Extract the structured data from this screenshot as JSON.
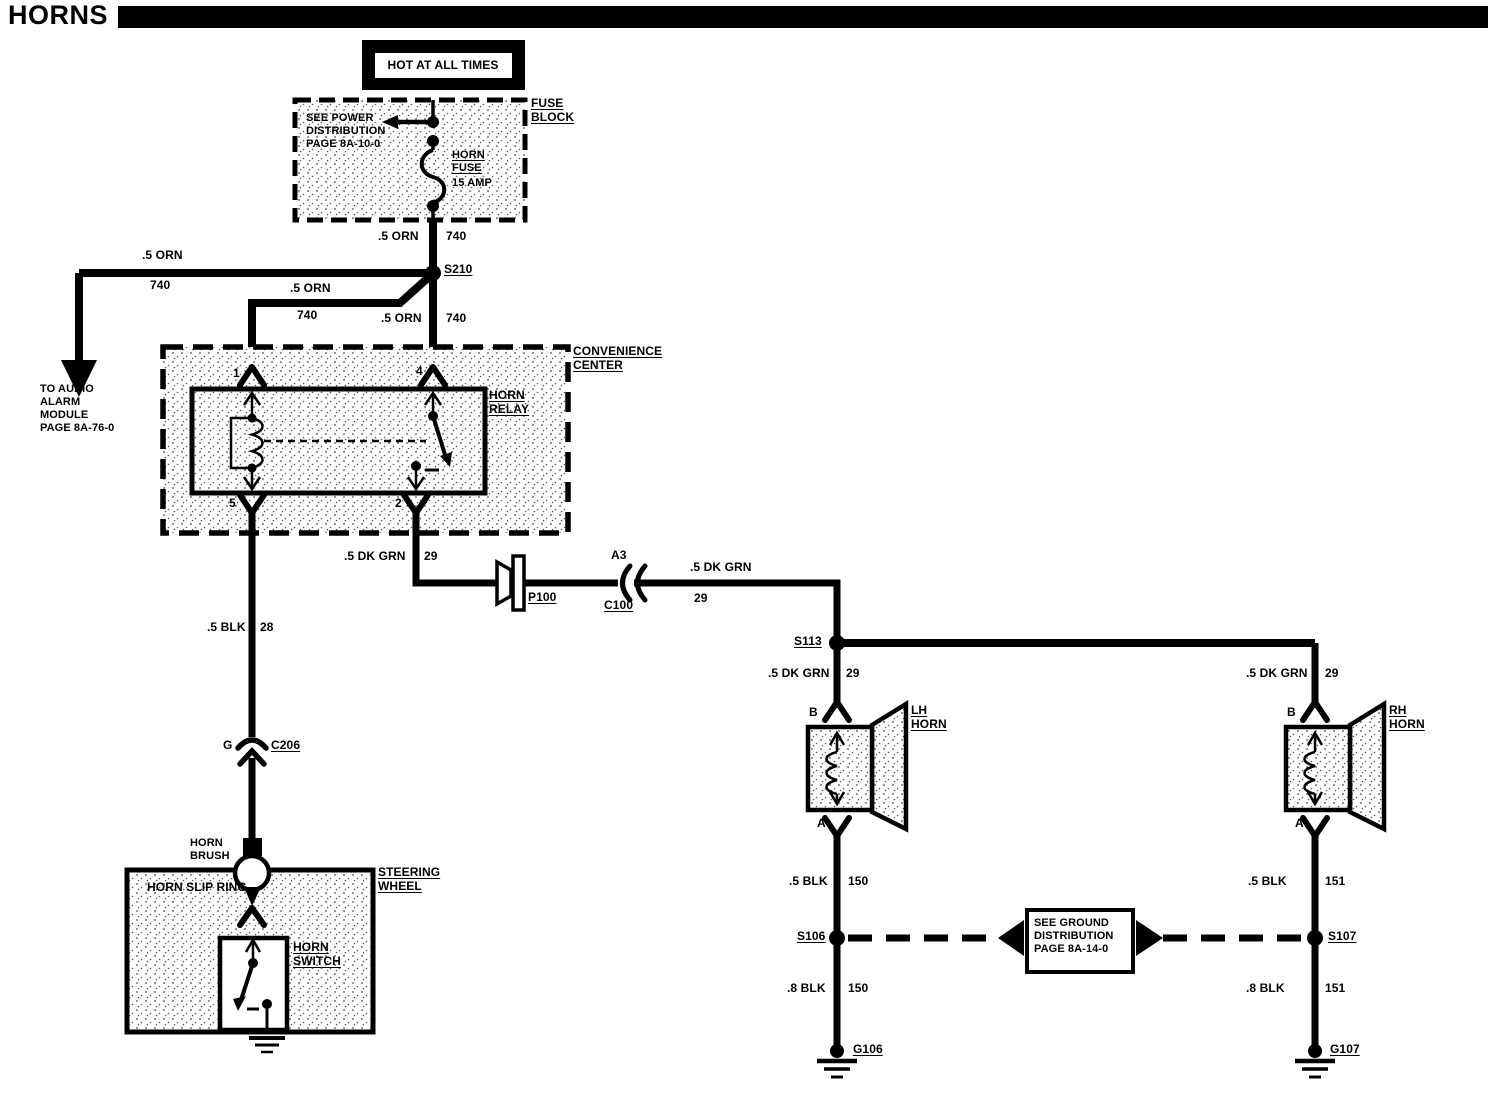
{
  "title": "HORNS",
  "colors": {
    "ink": "#000000",
    "paper": "#ffffff"
  },
  "power_source": {
    "label": "HOT AT ALL TIMES"
  },
  "fuse_block": {
    "name": "FUSE\nBLOCK",
    "power_note": "SEE POWER\nDISTRIBUTION\nPAGE 8A-10-0",
    "fuse_name": "HORN\nFUSE",
    "fuse_rating": "15 AMP"
  },
  "audio_note": "TO AUDIO\nALARM\nMODULE\nPAGE 8A-76-0",
  "ground_note": "SEE GROUND\nDISTRIBUTION\nPAGE 8A-14-0",
  "convenience_center": {
    "name": "CONVENIENCE\nCENTER",
    "relay": {
      "name": "HORN\nRELAY",
      "t1": "1",
      "t4": "4",
      "t5": "5",
      "t2": "2"
    }
  },
  "splices": {
    "s210": "S210",
    "s113": "S113",
    "s106": "S106",
    "s107": "S107"
  },
  "grounds": {
    "g106": "G106",
    "g107": "G107"
  },
  "connectors": {
    "p100": "P100",
    "c100": {
      "pin": "A3",
      "name": "C100"
    },
    "c206": {
      "pin": "G",
      "name": "C206"
    }
  },
  "steering": {
    "wheel": "STEERING\nWHEEL",
    "brush": "HORN\nBRUSH",
    "slip_ring": "HORN SLIP RING",
    "switch": "HORN\nSWITCH"
  },
  "horns": {
    "lh": {
      "name": "LH\nHORN",
      "b": "B",
      "a": "A"
    },
    "rh": {
      "name": "RH\nHORN",
      "b": "B",
      "a": "A"
    }
  },
  "wires": {
    "fuse_to_s210": {
      "color": ".5 ORN",
      "circuit": "740"
    },
    "s210_to_audio": {
      "color": ".5 ORN",
      "circuit": "740"
    },
    "s210_to_relay1": {
      "color": ".5 ORN",
      "circuit": "740"
    },
    "s210_to_relay4": {
      "color": ".5 ORN",
      "circuit": "740"
    },
    "relay2_out": {
      "color": ".5 DK GRN",
      "circuit": "29"
    },
    "c100_to_s113": {
      "color": ".5 DK GRN",
      "circuit": "29"
    },
    "s113_to_lh": {
      "color": ".5 DK GRN",
      "circuit": "29"
    },
    "s113_to_rh": {
      "color": ".5 DK GRN",
      "circuit": "29"
    },
    "relay5_out": {
      "color": ".5 BLK",
      "circuit": "28"
    },
    "lh_to_s106": {
      "color": ".5 BLK",
      "circuit": "150"
    },
    "s106_to_g106": {
      "color": ".8 BLK",
      "circuit": "150"
    },
    "rh_to_s107": {
      "color": ".5 BLK",
      "circuit": "151"
    },
    "s107_to_g107": {
      "color": ".8 BLK",
      "circuit": "151"
    }
  }
}
